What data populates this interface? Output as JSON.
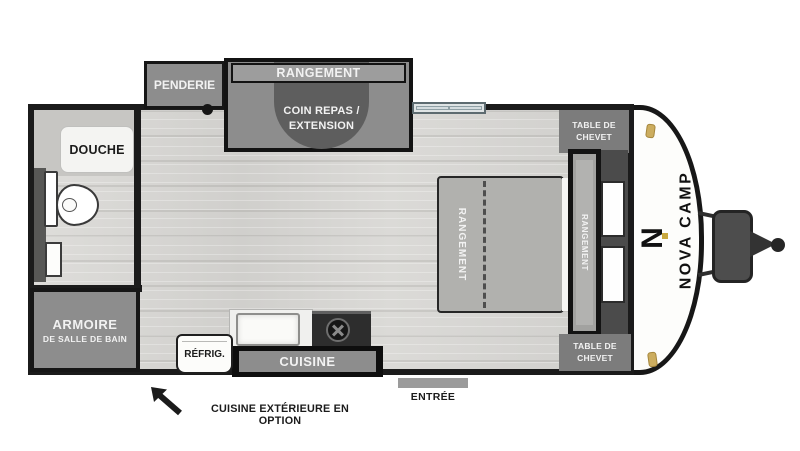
{
  "plan": {
    "brand": {
      "name": "NOVA CAMP",
      "logo_letter": "N"
    },
    "rooms": {
      "penderie": "PENDERIE",
      "rangement_top": "RANGEMENT",
      "coin_repas_line1": "COIN REPAS /",
      "coin_repas_line2": "EXTENSION",
      "douche": "DOUCHE",
      "armoire_line1": "ARMOIRE",
      "armoire_line2": "DE SALLE DE BAIN",
      "refrig": "RÉFRIG.",
      "cuisine": "CUISINE",
      "bed_storage": "RANGEMENT",
      "headboard_storage": "RANGEMENT",
      "nightstand_top_line1": "TABLE DE",
      "nightstand_top_line2": "CHEVET",
      "nightstand_bottom_line1": "TABLE DE",
      "nightstand_bottom_line2": "CHEVET",
      "entree": "ENTRÉE"
    },
    "note": "CUISINE EXTÉRIEURE EN OPTION",
    "colors": {
      "wall": "#1b1b1b",
      "cabinet_gray": "#8d8d8d",
      "dinette_gray": "#5e5e5e",
      "floor": "#d6d5d2",
      "accent_gold": "#ccad5f",
      "body_white": "#fdfdfb"
    }
  }
}
